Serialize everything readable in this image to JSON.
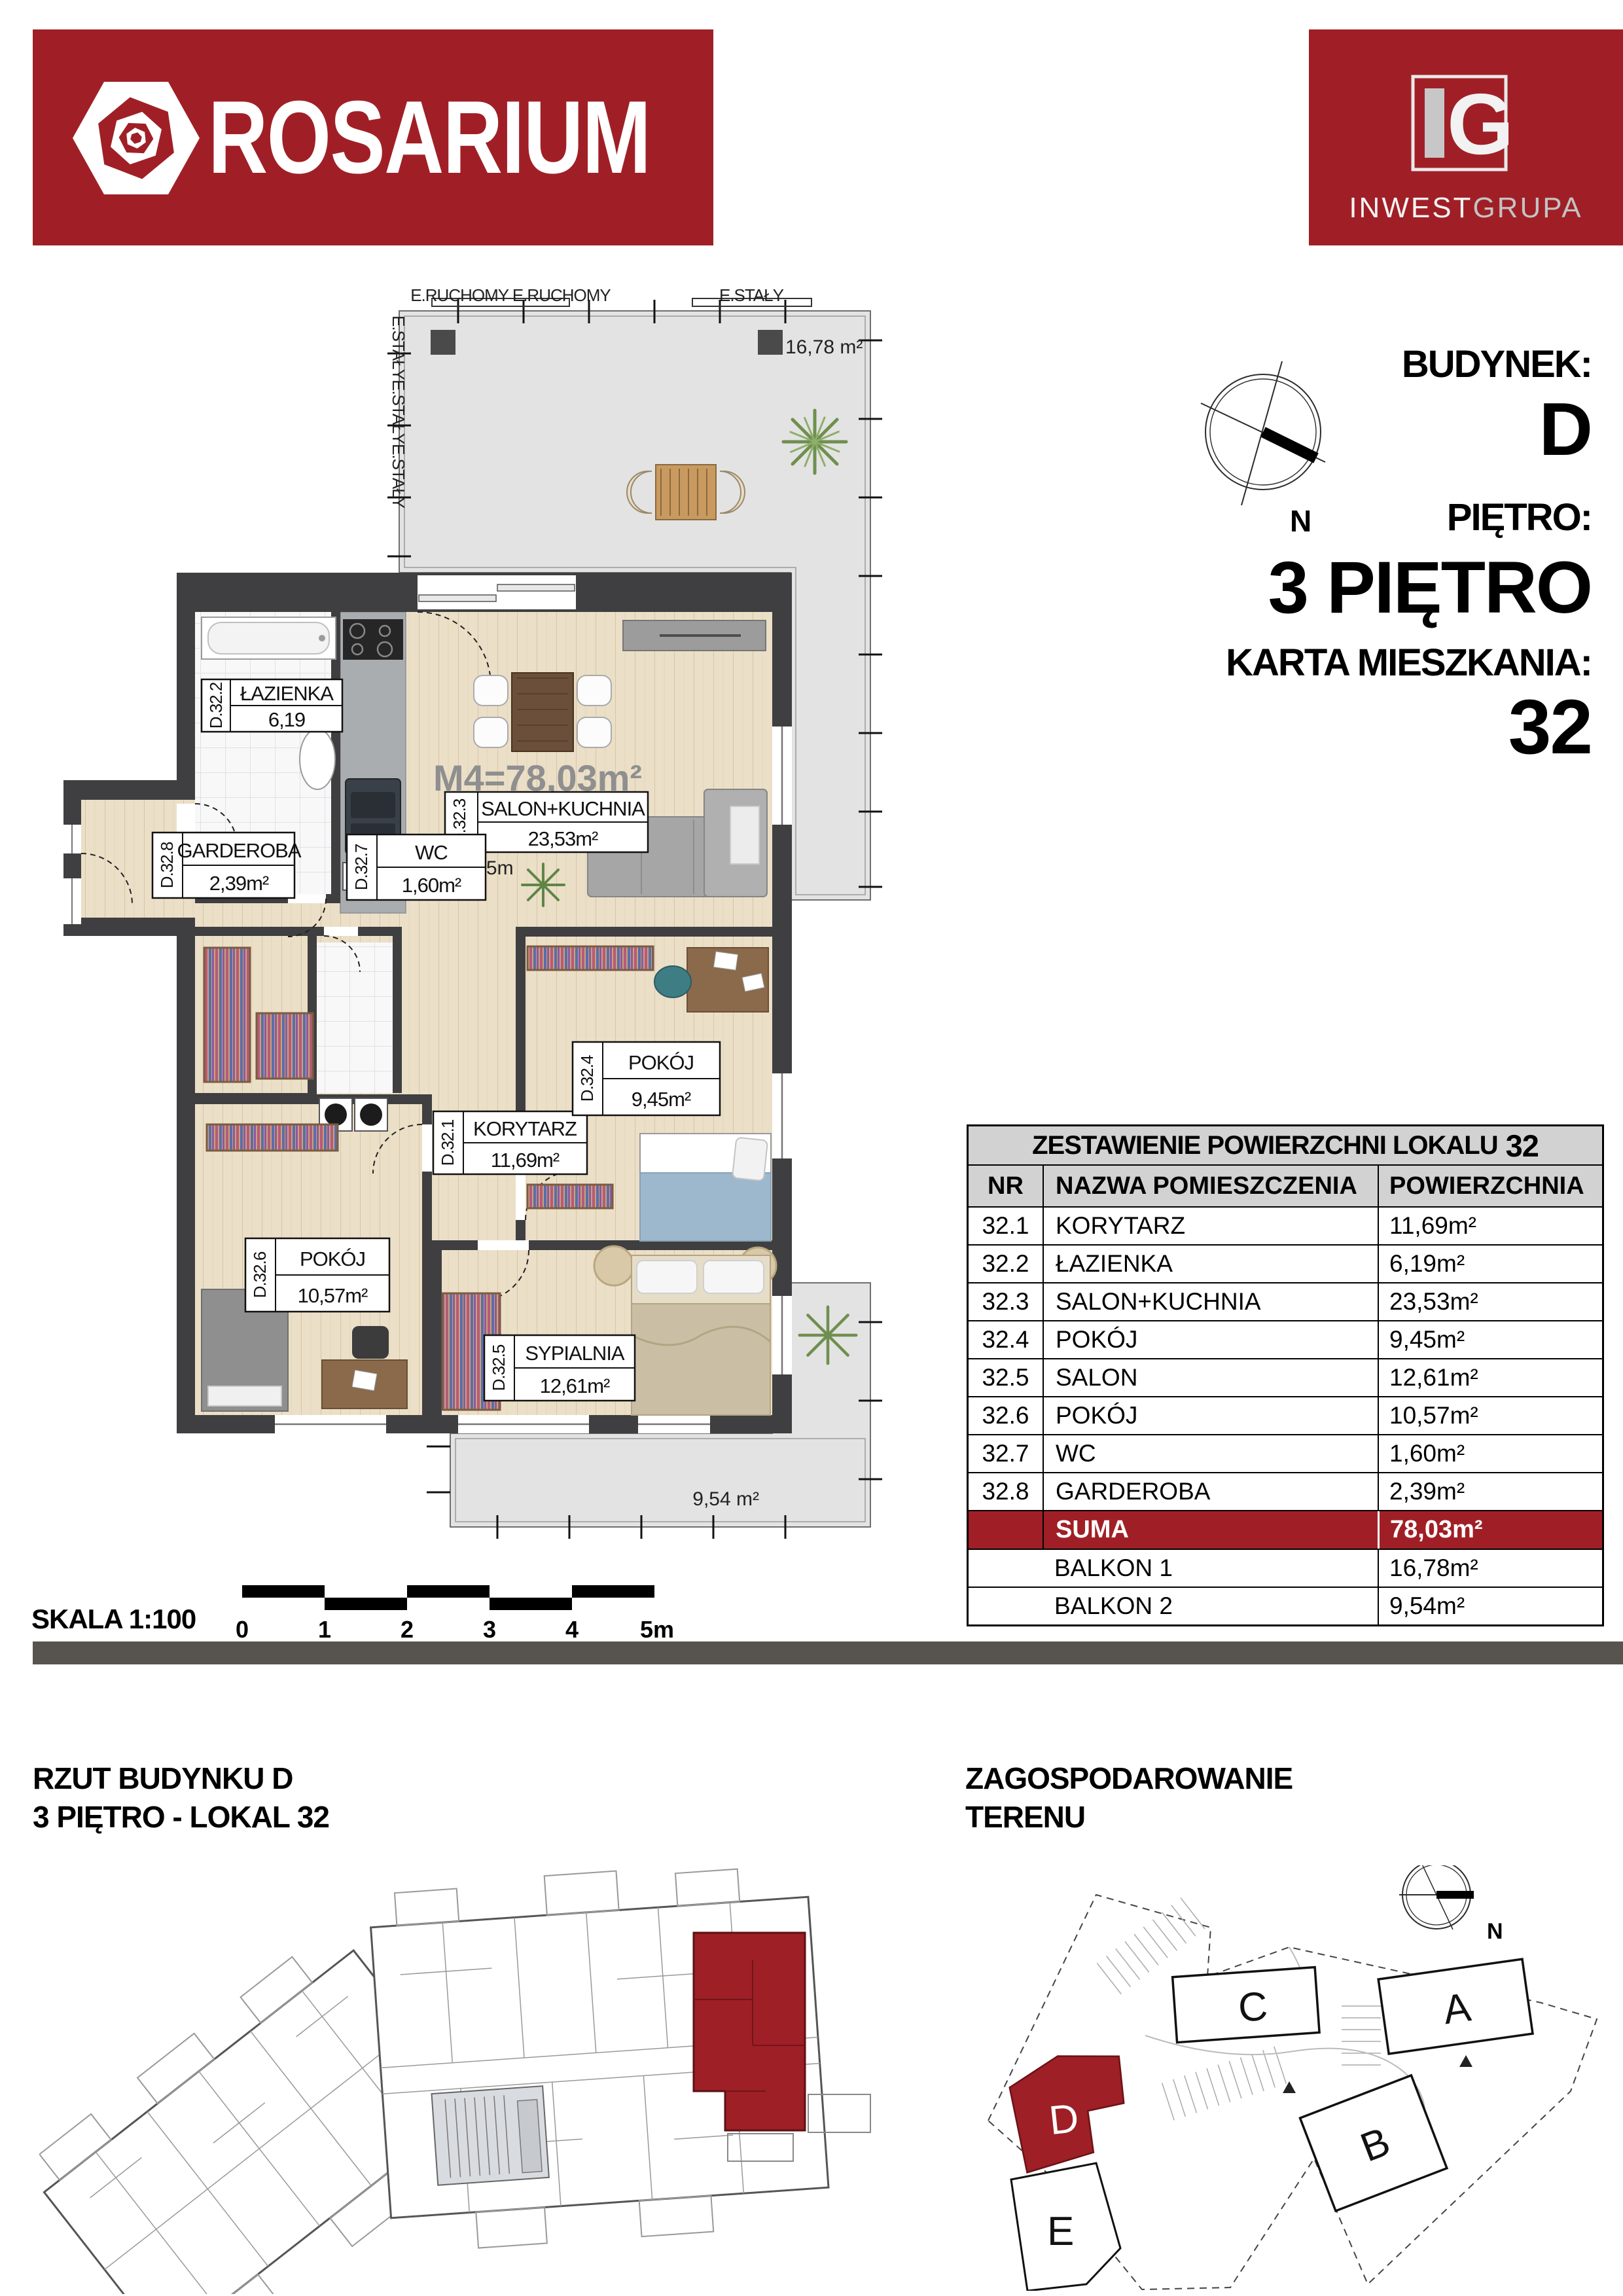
{
  "colors": {
    "brand_red": "#A01F26",
    "wall": "#3F3F41",
    "wood": "#EBDFC8",
    "terrace": "#E3E3E3",
    "table_header": "#D2D2D2"
  },
  "header": {
    "brand": "ROSARIUM",
    "logo_g": "G",
    "logo_company_1": "INWEST",
    "logo_company_2": "GRUPA",
    "compass_n": "N",
    "building_label": "BUDYNEK:",
    "building_value": "D",
    "floor_label": "PIĘTRO:",
    "floor_value": "3 PIĘTRO",
    "card_label": "KARTA MIESZKANIA:",
    "card_value": "32"
  },
  "plan": {
    "m4_label": "M4=78,03m²",
    "height_label": "H=2,65m",
    "balkon1_area": "16,78 m²",
    "balkon2_area": "9,54 m²",
    "edge_top_1": "E.RUCHOMY E.RUCHOMY",
    "edge_top_2": "E.STAŁY",
    "edge_left": "E.STAŁYE.STAŁYE.STAŁY",
    "rooms": [
      {
        "id": "D.32.2",
        "name": "ŁAZIENKA",
        "area": "6,19"
      },
      {
        "id": "D.32.3",
        "name": "SALON+KUCHNIA",
        "area": "23,53m²"
      },
      {
        "id": "D.32.8",
        "name": "GARDEROBA",
        "area": "2,39m²"
      },
      {
        "id": "D.32.7",
        "name": "WC",
        "area": "1,60m²"
      },
      {
        "id": "D.32.1",
        "name": "KORYTARZ",
        "area": "11,69m²"
      },
      {
        "id": "D.32.4",
        "name": "POKÓJ",
        "area": "9,45m²"
      },
      {
        "id": "D.32.6",
        "name": "POKÓJ",
        "area": "10,57m²"
      },
      {
        "id": "D.32.5",
        "name": "SYPIALNIA",
        "area": "12,61m²"
      }
    ]
  },
  "scalebar": {
    "label": "SKALA 1:100",
    "ticks": [
      "0",
      "1",
      "2",
      "3",
      "4",
      "5m"
    ]
  },
  "table": {
    "title_prefix": "ZESTAWIENIE POWIERZCHNI LOKALU",
    "title_number": "32",
    "col_nr": "NR",
    "col_name": "NAZWA POMIESZCZENIA",
    "col_area": "POWIERZCHNIA",
    "rows": [
      {
        "nr": "32.1",
        "name": "KORYTARZ",
        "area": "11,69m²"
      },
      {
        "nr": "32.2",
        "name": "ŁAZIENKA",
        "area": "6,19m²"
      },
      {
        "nr": "32.3",
        "name": "SALON+KUCHNIA",
        "area": "23,53m²"
      },
      {
        "nr": "32.4",
        "name": "POKÓJ",
        "area": "9,45m²"
      },
      {
        "nr": "32.5",
        "name": "SALON",
        "area": "12,61m²"
      },
      {
        "nr": "32.6",
        "name": "POKÓJ",
        "area": "10,57m²"
      },
      {
        "nr": "32.7",
        "name": "WC",
        "area": "1,60m²"
      },
      {
        "nr": "32.8",
        "name": "GARDEROBA",
        "area": "2,39m²"
      }
    ],
    "suma_label": "SUMA",
    "suma_area": "78,03m²",
    "balkon_rows": [
      {
        "label": "BALKON 1",
        "area": "16,78m²"
      },
      {
        "label": "BALKON 2",
        "area": "9,54m²"
      }
    ]
  },
  "sections": {
    "left_title_1": "RZUT BUDYNKU D",
    "left_title_2": "3 PIĘTRO - LOKAL 32",
    "right_title_1": "ZAGOSPODAROWANIE",
    "right_title_2": "TERENU",
    "site_compass_n": "N",
    "site_buildings": {
      "a": "A",
      "b": "B",
      "c": "C",
      "d": "D",
      "e": "E"
    }
  }
}
